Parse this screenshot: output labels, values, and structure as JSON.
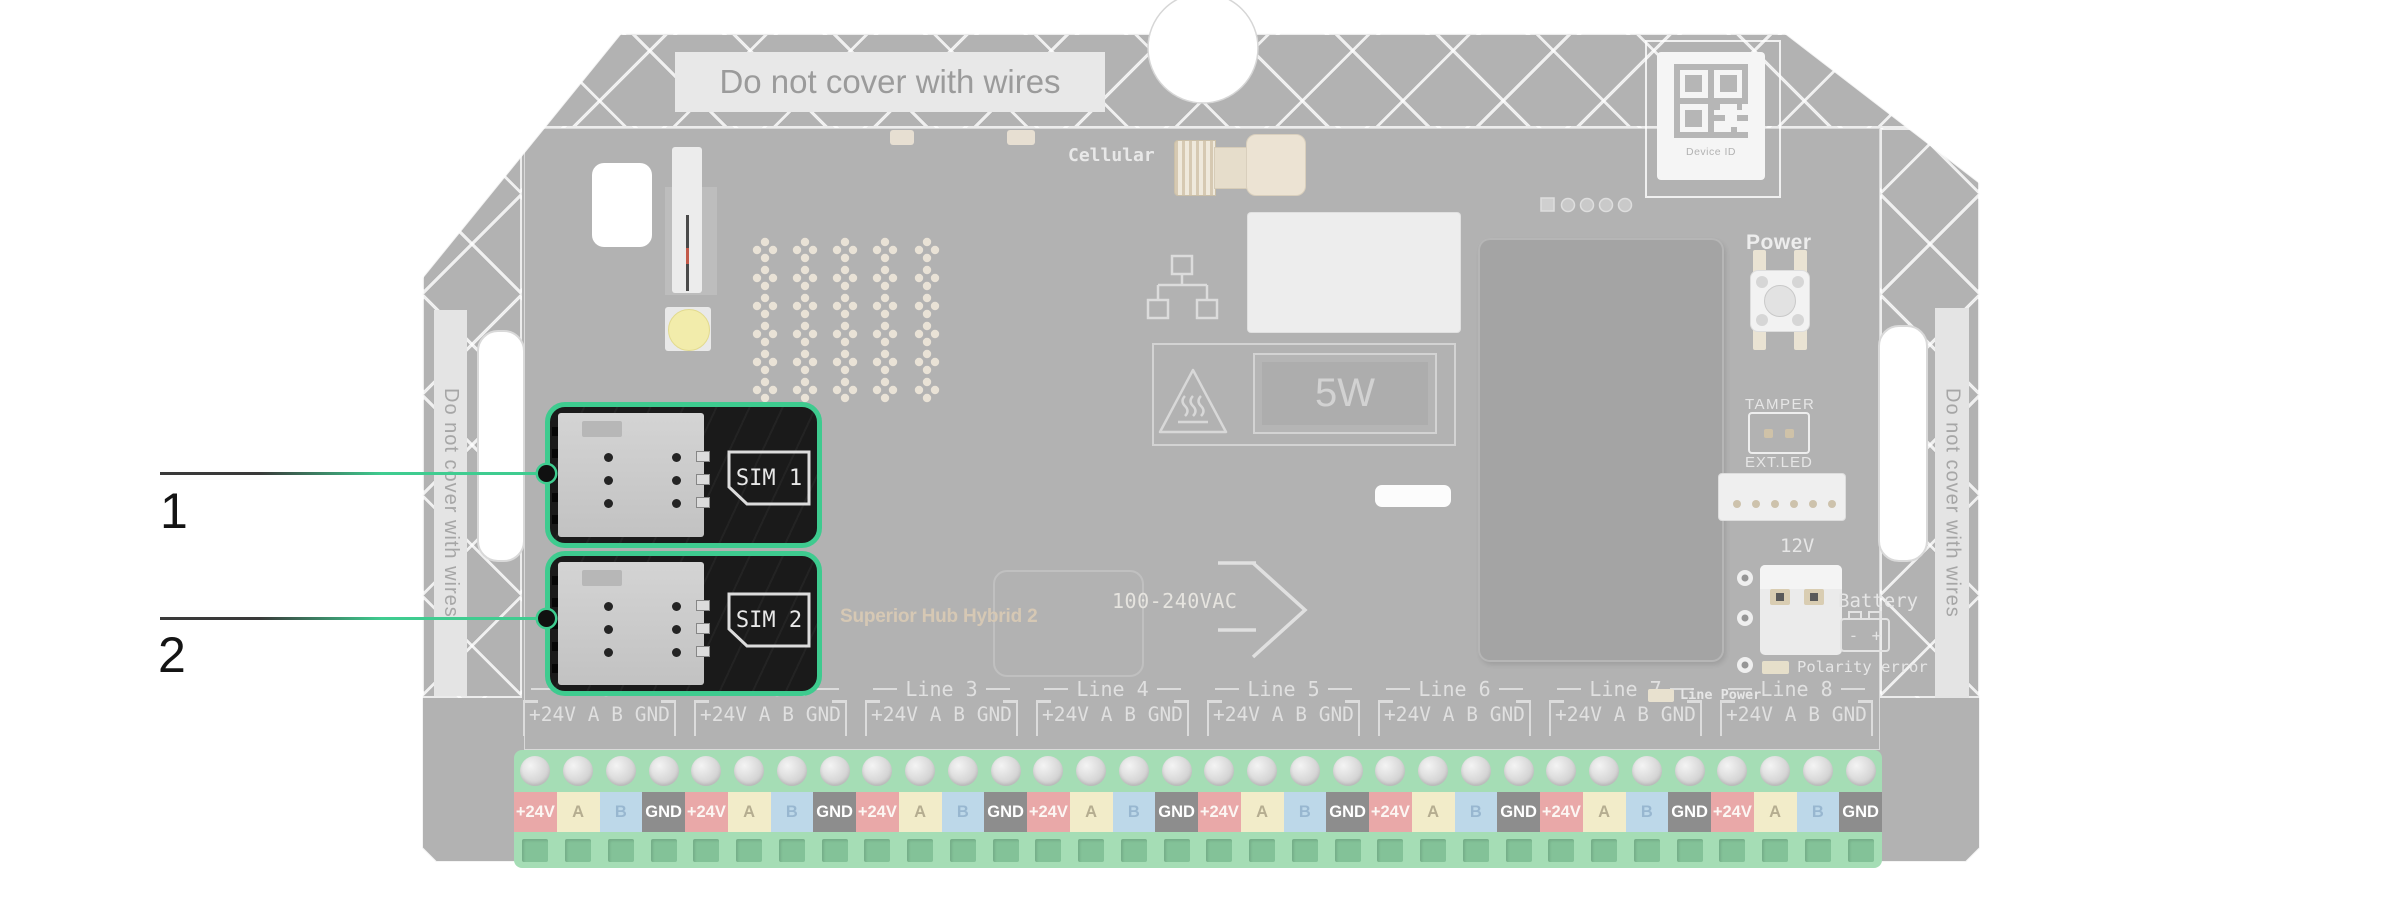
{
  "callouts": [
    {
      "number": "1"
    },
    {
      "number": "2"
    }
  ],
  "board": {
    "warnings": {
      "top": "Do not cover with wires",
      "left": "Do not cover with wires",
      "right": "Do not cover with wires"
    },
    "labels": {
      "cellular": "Cellular",
      "device_id": "Device ID",
      "power": "Power",
      "power_rating": "5W",
      "mains": "100-240VAC",
      "model": "Superior Hub Hybrid 2",
      "tamper": "TAMPER",
      "ext_led": "EXT.LED",
      "twelve_volt": "12V",
      "battery": "Battery",
      "battery_minus": "-",
      "battery_plus": "+",
      "polarity_error": "Polarity error",
      "line_power": "Line Power"
    },
    "sim_slots": [
      {
        "label": "SIM 1"
      },
      {
        "label": "SIM 2"
      }
    ],
    "line_groups": [
      {
        "label": "Line 1"
      },
      {
        "label": "Line 2"
      },
      {
        "label": "Line 3"
      },
      {
        "label": "Line 4"
      },
      {
        "label": "Line 5"
      },
      {
        "label": "Line 6"
      },
      {
        "label": "Line 7"
      },
      {
        "label": "Line 8"
      }
    ],
    "terminal_header": "+24V A B GND",
    "terminal_cells": [
      {
        "label": "+24V",
        "bg": "#e9a8a8",
        "fg": "#fcf6f3"
      },
      {
        "label": "A",
        "bg": "#f2ecc9",
        "fg": "#b5ad90"
      },
      {
        "label": "B",
        "bg": "#bdd8e9",
        "fg": "#98b7d0"
      },
      {
        "label": "GND",
        "bg": "#8d8d8d",
        "fg": "#ffffff"
      }
    ],
    "colors": {
      "highlight_green": "#3ecb8f",
      "board_gray": "#b2b2b2",
      "terminal_green": "#a5ddb5",
      "sim_panel_dark": "#1a1a1a"
    }
  }
}
